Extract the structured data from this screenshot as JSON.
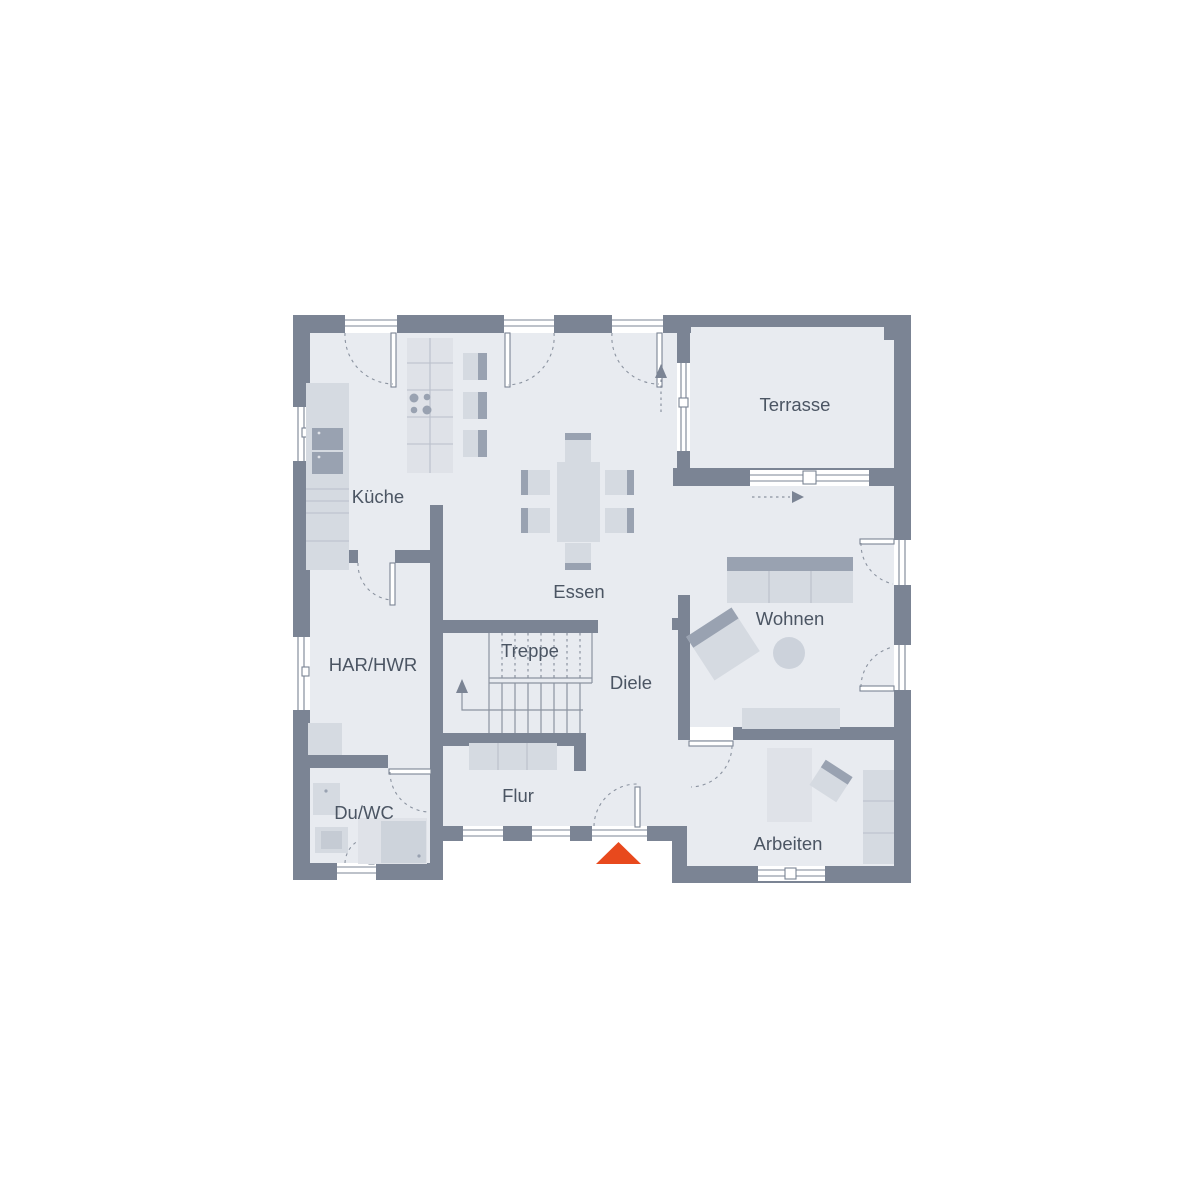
{
  "floor_plan": {
    "type": "ground-floor-plan",
    "rooms": {
      "kueche": {
        "label": "Küche"
      },
      "essen": {
        "label": "Essen"
      },
      "terrasse": {
        "label": "Terrasse"
      },
      "har_hwr": {
        "label": "HAR/HWR"
      },
      "treppe": {
        "label": "Treppe"
      },
      "diele": {
        "label": "Diele"
      },
      "wohnen": {
        "label": "Wohnen"
      },
      "du_wc": {
        "label": "Du/WC"
      },
      "flur": {
        "label": "Flur"
      },
      "arbeiten": {
        "label": "Arbeiten"
      }
    },
    "colors": {
      "wall": "#7b8494",
      "floor": "#e8ebf0",
      "furniture": "#d5dae1",
      "furniture_light": "#dfe2e8",
      "furniture_dark": "#99a2b1",
      "detail_line": "#b9bfca",
      "guide_line": "#8b93a0",
      "text": "#4b5563",
      "entrance_marker": "#e8491d",
      "window": "#ffffff",
      "background": "#ffffff"
    }
  }
}
